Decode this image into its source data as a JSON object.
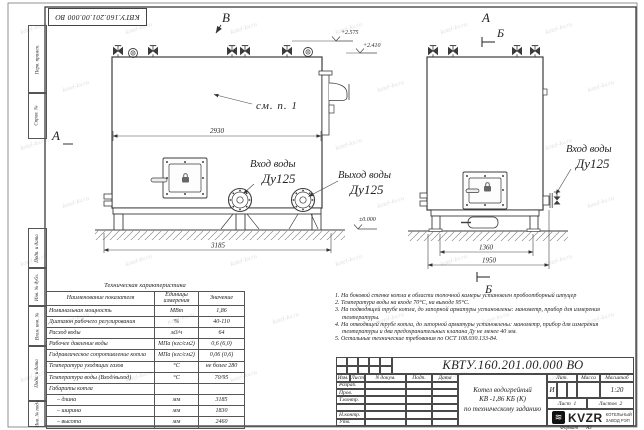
{
  "watermark": "kotel-kv.ru",
  "colors": {
    "line": "#3c3c3c",
    "paper": "#ffffff",
    "hatch": "#8f8f8f"
  },
  "frame": {
    "top_stamp": "КВТУ.160.201.00.000 ВО",
    "left_top_labels": [
      "Перв. примен.",
      "Справ. №"
    ],
    "left_bottom_labels": [
      "Подп. и дата",
      "Инв. № дубл.",
      "Взам. инв. №",
      "Подп. и дата",
      "Инв. № подл."
    ]
  },
  "drawing": {
    "view_b": "В",
    "view_a": "А",
    "section_b": "Б",
    "see_note": "см. п. 1",
    "elev_top": "+2.575",
    "elev_mid": "+2.410",
    "elev_zero": "±0.000",
    "dim_inner": "2930",
    "dim_overall": "3185",
    "dim_depth_inner": "1360",
    "dim_depth_overall": "1950",
    "inlet_line1": "Вход воды",
    "inlet_line2": "Ду125",
    "outlet_line1": "Выход воды",
    "outlet_line2": "Ду125",
    "inlet2_line1": "Вход воды",
    "inlet2_line2": "Ду125"
  },
  "spec_table": {
    "title": "Техническая характеристика",
    "headers": [
      "Наименование показателя",
      "Единицы измерения",
      "Значение"
    ],
    "rows": [
      [
        "Номинальная мощность",
        "МВт",
        "1,86"
      ],
      [
        "Диапазон рабочего регулирования",
        "%",
        "40-110"
      ],
      [
        "Расход воды",
        "м3/ч",
        "64"
      ],
      [
        "Рабочее давление воды",
        "МПа (кгс/см2)",
        "0,6 (6,0)"
      ],
      [
        "Гидравлическое сопротивление котла",
        "МПа (кгс/см2)",
        "0,06 (0,6)"
      ],
      [
        "Температура уходящих газов",
        "°С",
        "не более 280"
      ],
      [
        "Температура воды (Вход/выход)",
        "°С",
        "70/95"
      ],
      [
        "Габариты котла",
        "",
        ""
      ],
      [
        "– длина",
        "мм",
        "3185"
      ],
      [
        "– ширина",
        "мм",
        "1830"
      ],
      [
        "– высота",
        "мм",
        "2460"
      ]
    ]
  },
  "notes": [
    "1. На боковой стенке котла в области топочной камеры установлен пробоотборный штуцер",
    "2. Температура воды на входе 70°С, на выходе 95°С.",
    "3. На подводящей трубе котла, до запорной арматуры установлены: манометр, прибор для измерения температуры.",
    "4. На отводящей трубе котла, до запорной арматуры установлены: манометр, прибор для измерения температуры и два предохранительных клапана Ду не менее 40 мм.",
    "5. Остальные технические требования по ОСТ 108.030.133-84."
  ],
  "title_block": {
    "doc_number": "КВТУ.160.201.00.000  ВО",
    "col_headers": [
      "Изм.",
      "Лист",
      "N докум.",
      "Подп.",
      "Дата"
    ],
    "row_labels": [
      "Разраб.",
      "Пров.",
      "Т.контр.",
      "",
      "Н.контр.",
      "Утв."
    ],
    "title_line1": "Котел водогрейный",
    "title_line2": "КВ -1,86 КБ (К)",
    "title_line3": "по техническому заданию",
    "lit_header": "Лит.",
    "lit_value": "И",
    "mass_header": "Масса",
    "scale_header": "Масштаб",
    "scale_value": "1:20",
    "sheet_label": "Лист",
    "sheet_value": "1",
    "sheets_label": "Листов",
    "sheets_value": "2",
    "logo_word": "KVZR",
    "company_line1": "КОТЕЛЬНЫЙ",
    "company_line2": "ЗАВОД РЭП",
    "format_label": "Формат",
    "format_value": "А3"
  }
}
